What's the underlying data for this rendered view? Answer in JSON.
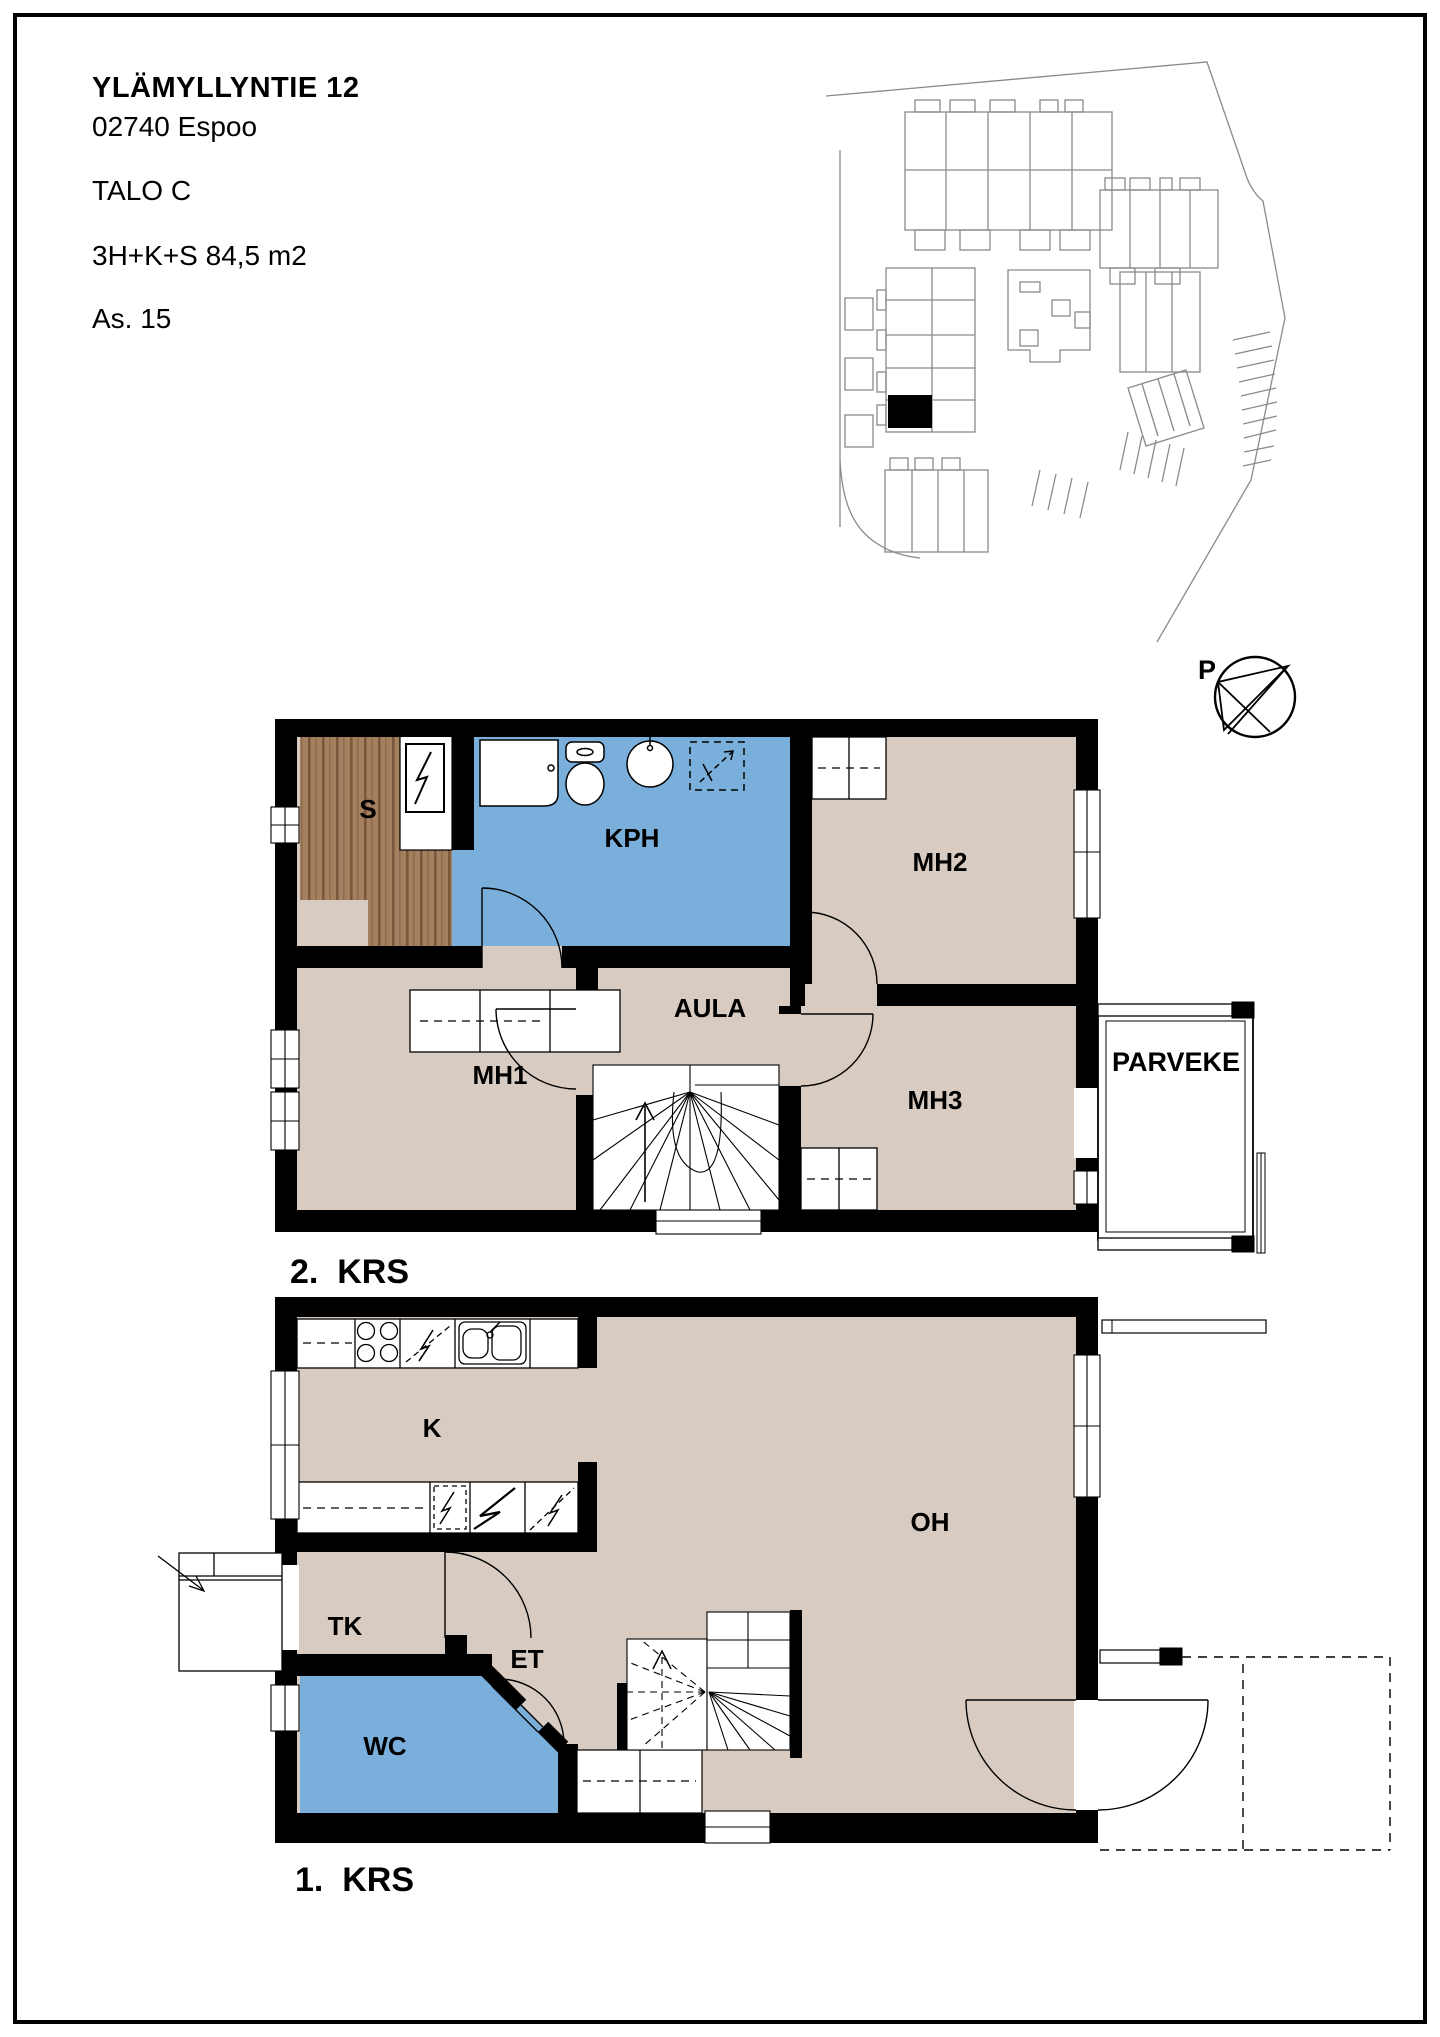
{
  "header": {
    "address_line1": "YLÄMYLLYNTIE 12",
    "address_line2": "02740 Espoo",
    "building": "TALO C",
    "apartment_type": "3H+K+S  84,5 m2",
    "apartment_id": "As. 15"
  },
  "compass": {
    "label": "P"
  },
  "floor2": {
    "label": "2.  KRS",
    "rooms": {
      "sauna": "S",
      "bathroom": "KPH",
      "bedroom2": "MH2",
      "bedroom1": "MH1",
      "hall": "AULA",
      "bedroom3": "MH3",
      "balcony": "PARVEKE"
    }
  },
  "floor1": {
    "label": "1.  KRS",
    "rooms": {
      "kitchen": "K",
      "living_room": "OH",
      "utility": "TK",
      "entry": "ET",
      "wc": "WC"
    }
  },
  "colors": {
    "room_fill": "#d8ccc2",
    "wet_room_fill": "#7aaedb",
    "sauna_wood": "#a5805e",
    "wall": "#000000",
    "siteplan_line": "#8a8a8a"
  }
}
